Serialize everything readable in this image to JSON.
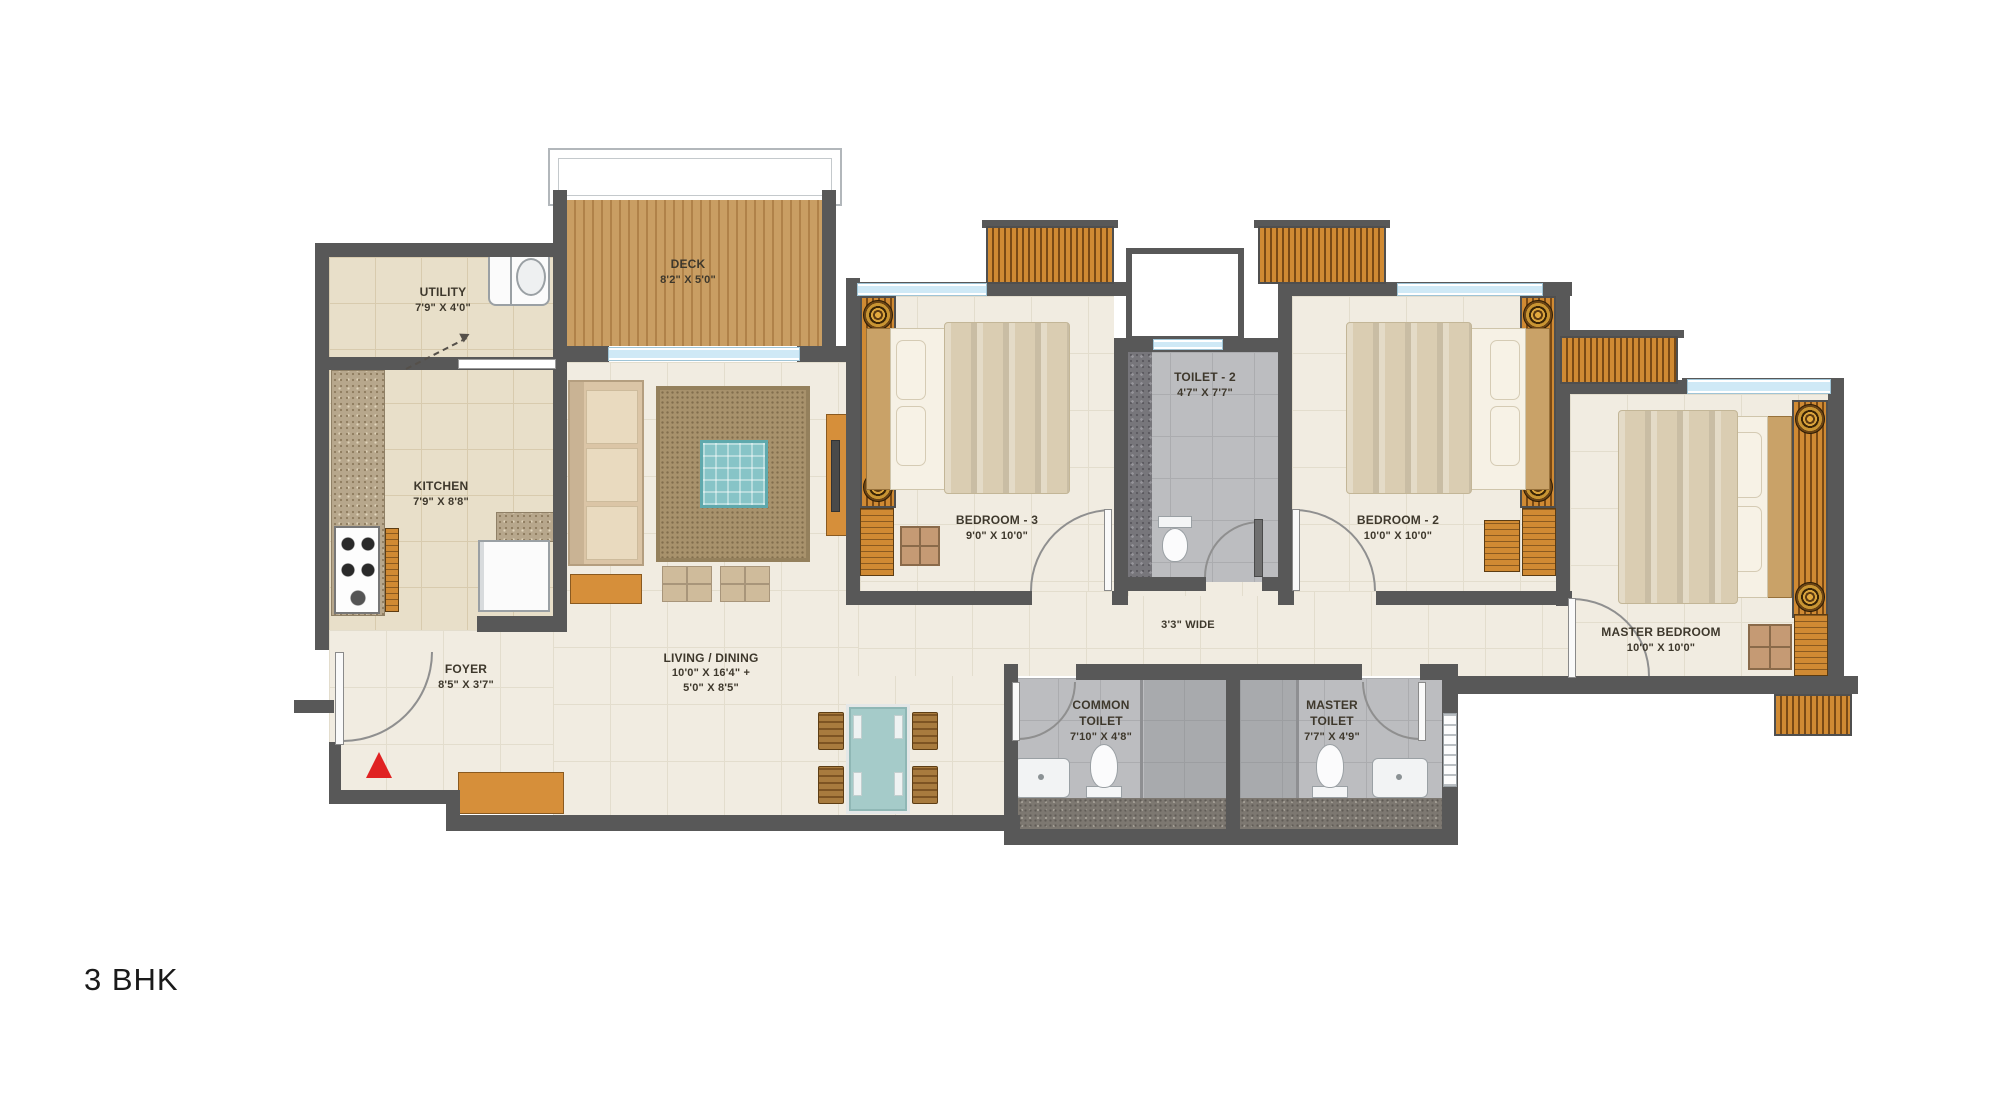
{
  "plan": {
    "type_label": "3 BHK"
  },
  "rooms": {
    "utility": {
      "name": "UTILITY",
      "dims": "7'9\" X 4'0\""
    },
    "deck": {
      "name": "DECK",
      "dims": "8'2\" X 5'0\""
    },
    "kitchen": {
      "name": "KITCHEN",
      "dims": "7'9\" X 8'8\""
    },
    "foyer": {
      "name": "FOYER",
      "dims": "8'5\" X 3'7\""
    },
    "living_dining": {
      "name": "LIVING / DINING",
      "dims_line1": "10'0\" X 16'4\" +",
      "dims_line2": "5'0\" X 8'5\""
    },
    "bedroom3": {
      "name": "BEDROOM - 3",
      "dims": "9'0\" X 10'0\""
    },
    "toilet2": {
      "name": "TOILET - 2",
      "dims": "4'7\" X 7'7\""
    },
    "bedroom2": {
      "name": "BEDROOM - 2",
      "dims": "10'0\" X 10'0\""
    },
    "master_bedroom": {
      "name": "MASTER BEDROOM",
      "dims": "10'0\" X 10'0\""
    },
    "passage": {
      "width_label": "3'3\" WIDE"
    },
    "common_toilet": {
      "name_line1": "COMMON",
      "name_line2": "TOILET",
      "dims": "7'10\" X 4'8\""
    },
    "master_toilet": {
      "name_line1": "MASTER",
      "name_line2": "TOILET",
      "dims": "7'7\" X 4'9\""
    }
  },
  "colors": {
    "wall": "#585858",
    "floor_cream": "#f1ece1",
    "floor_cream_line": "#e3ddcd",
    "floor_beige": "#e8dfc9",
    "floor_beige_line": "#d8cbae",
    "floor_gray": "#bcbdc0",
    "floor_gray_line": "#abacaf",
    "deck_wood": "#c99e63",
    "deck_wood_line": "#b08249",
    "window_glass": "#cfe9f6",
    "wood_accent": "#d68f3a",
    "wood_dark": "#8a5a20",
    "granite": "#b7a78c",
    "sofa": "#dbc5a6",
    "mattress": "#f6f1e5",
    "bed_linen": "#dacdb2",
    "carpet": "#a8926c",
    "rug": "#87c4c7",
    "table_glass": "#a5cbc9",
    "label_text": "#3e382c",
    "entry_marker": "#e02222"
  }
}
